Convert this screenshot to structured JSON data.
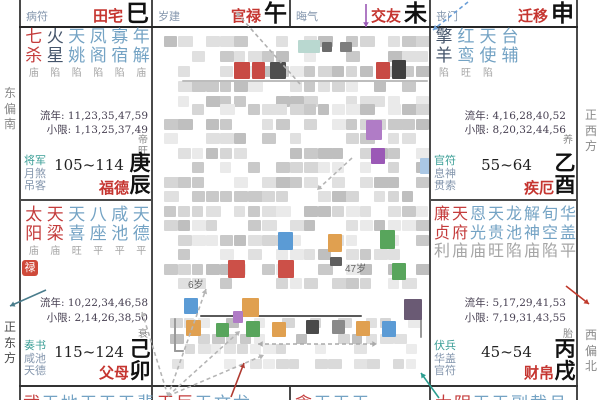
{
  "colors": {
    "red": "#c43c3c",
    "dark": "#44546a",
    "blue": "#74a3c4",
    "status": "#a5a5a5",
    "sha_first": "#3a9e96",
    "sha_rest": "#8496ad",
    "palace_red": "#c53530",
    "branch_black": "#111111",
    "badge_bg": "#cf4a3a"
  },
  "directions": {
    "left": [
      "东偏南",
      "正东方"
    ],
    "right": [
      "正西方",
      "西偏北"
    ]
  },
  "strips": [
    {
      "sha": "病符",
      "name": "田宅",
      "branch": "巳"
    },
    {
      "sha": "岁建",
      "name": "官禄",
      "branch": "午"
    },
    {
      "sha": "晦气",
      "name": "交友",
      "branch": "未"
    },
    {
      "sha": "丧门",
      "name": "迁移",
      "branch": "申"
    }
  ],
  "palaces": {
    "chen": {
      "stars": [
        [
          "七杀",
          "red",
          "庙"
        ],
        [
          "火星",
          "dark",
          "陷"
        ],
        [
          "天姚",
          "blue",
          "陷"
        ],
        [
          "凤阁",
          "blue",
          "陷"
        ],
        [
          "寡宿",
          "blue",
          "陷"
        ],
        [
          "年解",
          "blue",
          "庙"
        ]
      ],
      "liunian": "流年: 11,23,35,47,59",
      "xiaoxian": "小限: 1,13,25,37,49",
      "sha": [
        "将军",
        "月煞",
        "吊客"
      ],
      "range": "105~114",
      "limit_name": "福德",
      "stage": "帝旺",
      "ganzhi": "庚辰"
    },
    "mao": {
      "stars": [
        [
          "太阳",
          "red",
          "庙"
        ],
        [
          "天梁",
          "red",
          "庙"
        ],
        [
          "天喜",
          "blue",
          "旺"
        ],
        [
          "八座",
          "blue",
          "平"
        ],
        [
          "咸池",
          "blue",
          "平"
        ],
        [
          "天德",
          "blue",
          "平"
        ]
      ],
      "hua": "禄",
      "liunian": "流年: 10,22,34,46,58",
      "xiaoxian": "小限: 2,14,26,38,50",
      "sha": [
        "奏书",
        "咸池",
        "天德"
      ],
      "range": "115~124",
      "limit_name": "父母",
      "stage": "衰",
      "ganzhi": "己卯"
    },
    "you": {
      "stars": [
        [
          "擎羊",
          "dark",
          "陷"
        ],
        [
          "红鸾",
          "blue",
          "旺"
        ],
        [
          "天使",
          "blue",
          "陷"
        ],
        [
          "台辅",
          "blue",
          ""
        ]
      ],
      "liunian": "流年: 4,16,28,40,52",
      "xiaoxian": "小限: 8,20,32,44,56",
      "sha": [
        "官符",
        "息神",
        "贯索"
      ],
      "range": "55~64",
      "limit_name": "疾厄",
      "stage": "养",
      "ganzhi": "乙酉"
    },
    "xu": {
      "stars": [
        [
          "廉贞",
          "red",
          "利"
        ],
        [
          "天府",
          "red",
          "庙"
        ],
        [
          "恩光",
          "blue",
          "庙"
        ],
        [
          "天贵",
          "blue",
          "旺"
        ],
        [
          "龙池",
          "blue",
          "陷"
        ],
        [
          "解神",
          "blue",
          "庙"
        ],
        [
          "旬空",
          "blue",
          "陷"
        ],
        [
          "华盖",
          "blue",
          "平"
        ]
      ],
      "liunian": "流年: 5,17,29,41,53",
      "xiaoxian": "小限: 7,19,31,43,55",
      "sha": [
        "伏兵",
        "华盖",
        "官符"
      ],
      "range": "45~54",
      "limit_name": "财帛",
      "stage": "胎",
      "ganzhi": "丙戌"
    }
  },
  "bottom_row": [
    {
      "text": "武天地天天天蜚",
      "red": 1
    },
    {
      "text": "天巨天文龙",
      "red": 2
    },
    {
      "text": "贪天天天",
      "red": 1
    },
    {
      "text": "太阴天天副截月",
      "red": 2
    }
  ],
  "center": {
    "fragments": [
      {
        "t": "6岁",
        "x": 188,
        "y": 276
      },
      {
        "t": "47岁",
        "x": 345,
        "y": 260
      }
    ],
    "greys": [
      "#c9c9c9",
      "#d6d6d6",
      "#e0e0e0",
      "#bfbfbf",
      "#eaeaea"
    ],
    "light_greys": [
      "#e3e3e3",
      "#ececec",
      "#dadada"
    ],
    "mosaics": [
      {
        "x": 164,
        "y": 36,
        "w": 258,
        "h": 66,
        "tile": 11,
        "px": 14,
        "py": 15,
        "skip": 0.38,
        "seed": 11
      },
      {
        "x": 164,
        "y": 104,
        "w": 258,
        "h": 184,
        "tile": 11,
        "px": 14,
        "py": 14.5,
        "skip": 0.3,
        "seed": 23
      },
      {
        "x": 170,
        "y": 318,
        "w": 244,
        "h": 20,
        "tile": 10,
        "px": 14,
        "py": 16,
        "skip": 0.45,
        "seed": 5
      },
      {
        "x": 172,
        "y": 344,
        "w": 236,
        "h": 30,
        "tile": 10,
        "px": 13,
        "py": 15,
        "skip": 0.55,
        "seed": 9,
        "light": true
      }
    ],
    "rects": [
      {
        "x": 208,
        "y": 290,
        "w": 218,
        "h": 26,
        "c": "#ffffff"
      },
      {
        "x": 182,
        "y": 80,
        "w": 246,
        "h": 2,
        "c": "#bdbdbd"
      },
      {
        "x": 200,
        "y": 315,
        "w": 162,
        "h": 2,
        "c": "#5a5a5a"
      },
      {
        "x": 174,
        "y": 318,
        "w": 2,
        "h": 34,
        "c": "#9a9a9a"
      },
      {
        "x": 174,
        "y": 350,
        "w": 10,
        "h": 2,
        "c": "#9a9a9a"
      },
      {
        "x": 420,
        "y": 300,
        "w": 2,
        "h": 38,
        "c": "#9a9a9a"
      }
    ],
    "blocks": [
      {
        "x": 298,
        "y": 40,
        "w": 22,
        "h": 13,
        "c": "#b9d8d0"
      },
      {
        "x": 322,
        "y": 42,
        "w": 10,
        "h": 10,
        "c": "#6b6b6b"
      },
      {
        "x": 340,
        "y": 42,
        "w": 12,
        "h": 10,
        "c": "#7d7d7d"
      },
      {
        "x": 234,
        "y": 62,
        "w": 16,
        "h": 17,
        "c": "#c84a44"
      },
      {
        "x": 252,
        "y": 62,
        "w": 13,
        "h": 17,
        "c": "#c84a44"
      },
      {
        "x": 270,
        "y": 62,
        "w": 16,
        "h": 17,
        "c": "#4f4f4f"
      },
      {
        "x": 376,
        "y": 62,
        "w": 14,
        "h": 17,
        "c": "#c84a44"
      },
      {
        "x": 392,
        "y": 60,
        "w": 14,
        "h": 19,
        "c": "#3f3f3f"
      },
      {
        "x": 366,
        "y": 120,
        "w": 16,
        "h": 20,
        "c": "#b07cc6"
      },
      {
        "x": 371,
        "y": 148,
        "w": 14,
        "h": 16,
        "c": "#9b59b6"
      },
      {
        "x": 420,
        "y": 158,
        "w": 11,
        "h": 16,
        "c": "#aac7e4"
      },
      {
        "x": 278,
        "y": 232,
        "w": 15,
        "h": 18,
        "c": "#5b9bd5"
      },
      {
        "x": 328,
        "y": 234,
        "w": 14,
        "h": 18,
        "c": "#e0a050"
      },
      {
        "x": 380,
        "y": 230,
        "w": 15,
        "h": 19,
        "c": "#58a55c"
      },
      {
        "x": 228,
        "y": 260,
        "w": 17,
        "h": 18,
        "c": "#cc5048"
      },
      {
        "x": 278,
        "y": 260,
        "w": 16,
        "h": 18,
        "c": "#cc5048"
      },
      {
        "x": 330,
        "y": 257,
        "w": 12,
        "h": 9,
        "c": "#5f5f5f"
      },
      {
        "x": 392,
        "y": 263,
        "w": 14,
        "h": 17,
        "c": "#58a55c"
      },
      {
        "x": 184,
        "y": 298,
        "w": 14,
        "h": 16,
        "c": "#5b9bd5"
      },
      {
        "x": 242,
        "y": 298,
        "w": 17,
        "h": 19,
        "c": "#e0a050"
      },
      {
        "x": 233,
        "y": 311,
        "w": 10,
        "h": 12,
        "c": "#b07cc6"
      },
      {
        "x": 404,
        "y": 299,
        "w": 18,
        "h": 21,
        "c": "#6a5a74"
      },
      {
        "x": 186,
        "y": 320,
        "w": 15,
        "h": 16,
        "c": "#e0a050"
      },
      {
        "x": 216,
        "y": 323,
        "w": 13,
        "h": 14,
        "c": "#58a55c"
      },
      {
        "x": 246,
        "y": 321,
        "w": 14,
        "h": 16,
        "c": "#58a55c"
      },
      {
        "x": 272,
        "y": 322,
        "w": 14,
        "h": 15,
        "c": "#e0a050"
      },
      {
        "x": 306,
        "y": 320,
        "w": 13,
        "h": 14,
        "c": "#4a4a4a"
      },
      {
        "x": 332,
        "y": 320,
        "w": 13,
        "h": 14,
        "c": "#8a8a8a"
      },
      {
        "x": 356,
        "y": 321,
        "w": 14,
        "h": 15,
        "c": "#e0a050"
      },
      {
        "x": 382,
        "y": 321,
        "w": 14,
        "h": 16,
        "c": "#5b9bd5"
      }
    ],
    "arrows": [
      {
        "x1": 300,
        "y1": 84,
        "x2": 236,
        "y2": 12,
        "c": "#b0b0b0",
        "d": "4 3"
      },
      {
        "x1": 366,
        "y1": 4,
        "x2": 366,
        "y2": 27,
        "c": "#9b59b6",
        "d": ""
      },
      {
        "x1": 468,
        "y1": 2,
        "x2": 433,
        "y2": 30,
        "c": "#6b9fd8",
        "d": "4 3"
      },
      {
        "x1": 46,
        "y1": 290,
        "x2": 10,
        "y2": 306,
        "c": "#4a7d8c",
        "d": ""
      },
      {
        "x1": 566,
        "y1": 286,
        "x2": 589,
        "y2": 304,
        "c": "#c0392b",
        "d": ""
      },
      {
        "x1": 231,
        "y1": 397,
        "x2": 244,
        "y2": 363,
        "c": "#b03a30",
        "d": ""
      },
      {
        "x1": 439,
        "y1": 398,
        "x2": 421,
        "y2": 373,
        "c": "#2a9d8f",
        "d": ""
      },
      {
        "x1": 168,
        "y1": 396,
        "x2": 206,
        "y2": 289,
        "c": "#b5b5b5",
        "d": "4 3"
      },
      {
        "x1": 168,
        "y1": 396,
        "x2": 240,
        "y2": 331,
        "c": "#b5b5b5",
        "d": "4 3"
      },
      {
        "x1": 168,
        "y1": 396,
        "x2": 264,
        "y2": 355,
        "c": "#b5b5b5",
        "d": "4 3"
      },
      {
        "x1": 168,
        "y1": 396,
        "x2": 142,
        "y2": 312,
        "c": "#b5b5b5",
        "d": "4 3"
      },
      {
        "x1": 258,
        "y1": 344,
        "x2": 377,
        "y2": 344,
        "c": "#aaaaaa",
        "d": "4 3",
        "double": true
      },
      {
        "x1": 352,
        "y1": 158,
        "x2": 317,
        "y2": 190,
        "c": "#b5b5b5",
        "d": "4 3"
      }
    ]
  }
}
